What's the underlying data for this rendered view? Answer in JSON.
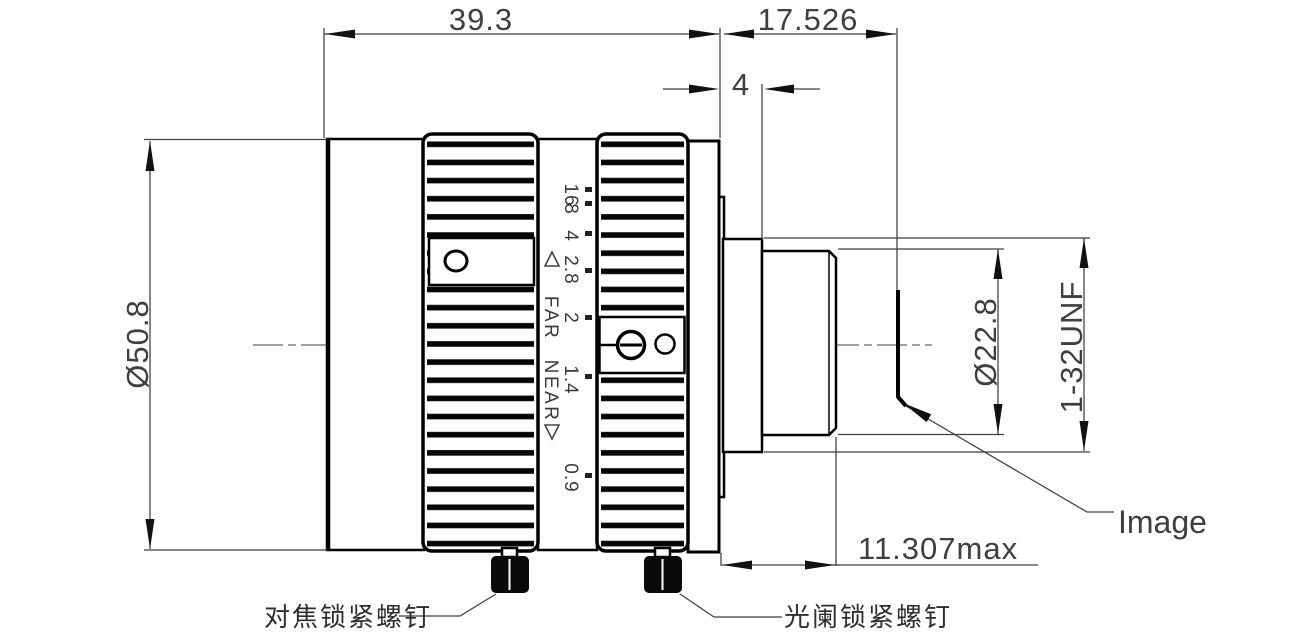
{
  "meta": {
    "drawing_type": "lens mechanical drawing",
    "background_color": "#ffffff",
    "line_color": "#000000",
    "dimension_color": "#3f3f3f"
  },
  "dimensions": {
    "front_length": "39.3",
    "flange_focal_distance": "17.526",
    "step_length": "4",
    "body_diameter": "Ø50.8",
    "mount_diameter": "Ø22.8",
    "mount_thread": "1-32UNF",
    "rear_protrusion_max": "11.307max"
  },
  "labels": {
    "image_plane": "Image",
    "focus_lock_screw": "对焦锁紧螺钉",
    "iris_lock_screw": "光阑锁紧螺钉"
  },
  "focus_ring": {
    "far": "FAR",
    "near": "NEAR"
  },
  "aperture_scale": {
    "values": [
      "16",
      "8",
      "4",
      "2.8",
      "2",
      "1.4",
      "0.9"
    ]
  }
}
